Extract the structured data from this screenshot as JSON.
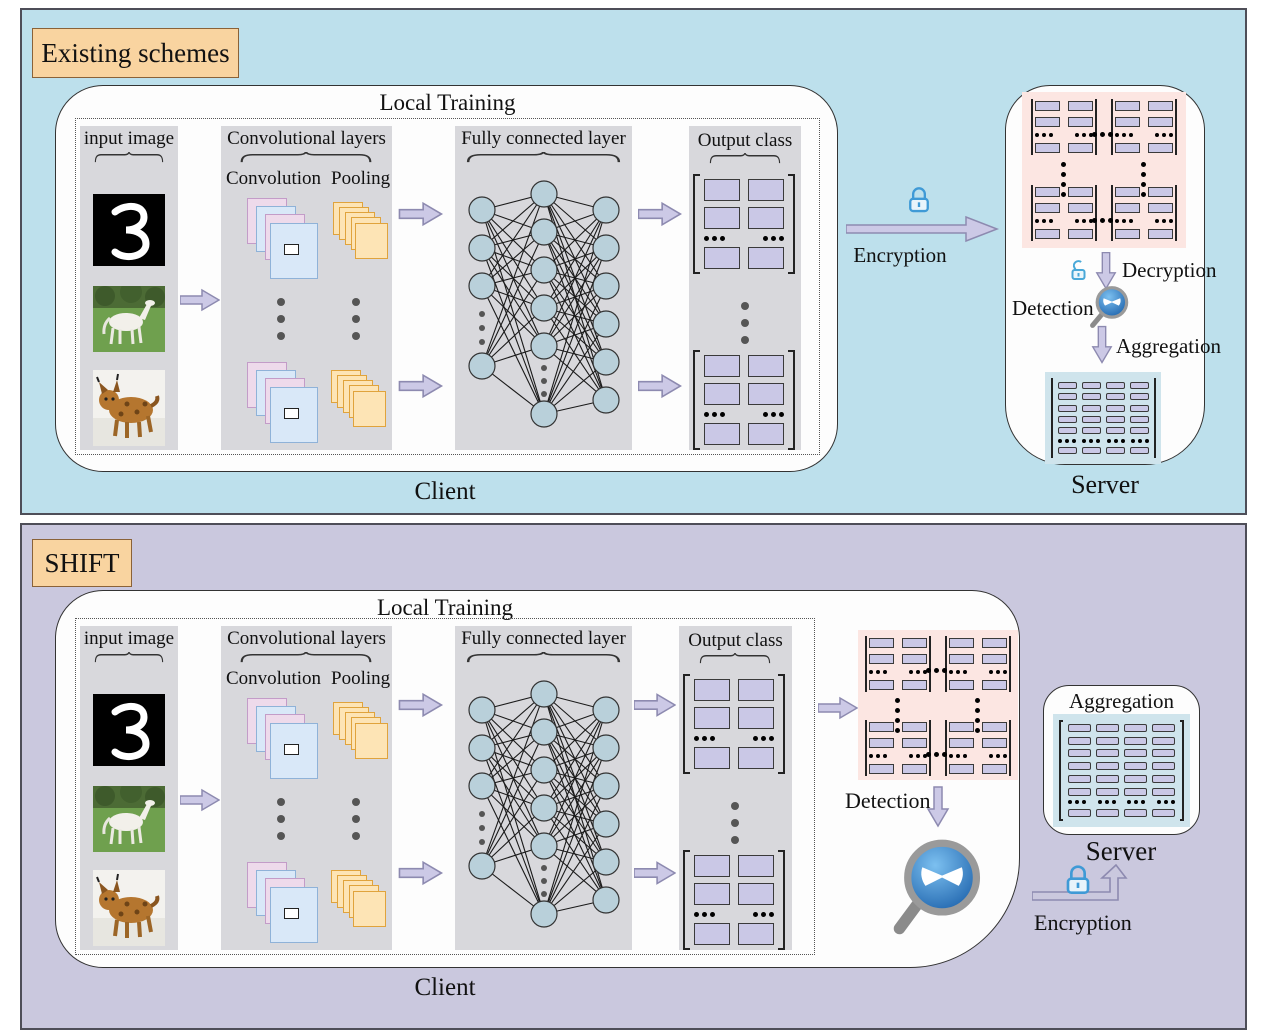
{
  "panel_existing": {
    "title": "Existing schemes",
    "client": {
      "local_training_label": "Local Training",
      "input_label": "input image",
      "conv_layers_label": "Convolutional layers",
      "convolution_label": "Convolution",
      "pooling_label": "Pooling",
      "fc_label": "Fully connected layer",
      "output_label": "Output class",
      "client_label": "Client"
    },
    "encryption_label": "Encryption",
    "server": {
      "decryption_label": "Decryption",
      "detection_label": "Detection",
      "aggregation_label": "Aggregation",
      "server_label": "Server"
    }
  },
  "panel_shift": {
    "title": "SHIFT",
    "client": {
      "local_training_label": "Local Training",
      "input_label": "input image",
      "conv_layers_label": "Convolutional layers",
      "convolution_label": "Convolution",
      "pooling_label": "Pooling",
      "fc_label": "Fully connected layer",
      "output_label": "Output class",
      "detection_label": "Detection",
      "client_label": "Client"
    },
    "server": {
      "aggregation_label": "Aggregation",
      "server_label": "Server"
    },
    "encryption_label": "Encryption"
  },
  "icons": {
    "lock": "closed-lock-icon",
    "unlock": "open-lock-icon",
    "detector": "magnifier-devil-icon",
    "arrow": "block-arrow-icon",
    "input_images": [
      "handwritten-digit-3",
      "white-horse-photo",
      "lynx-photo"
    ]
  },
  "colors": {
    "panel_existing_bg": "#bde0ec",
    "panel_shift_bg": "#cac8de",
    "title_box_bg": "#f9d4a0",
    "column_bg": "#d8d8dc",
    "weight_cell": "#cac8e6",
    "encrypted_box_bg": "#fce6e2",
    "aggregated_box_bg": "#cfe4ec",
    "arrow_fill": "#ccc9e6",
    "lock_blue": "#3f9ad6",
    "node_fill": "#b9d0da"
  }
}
